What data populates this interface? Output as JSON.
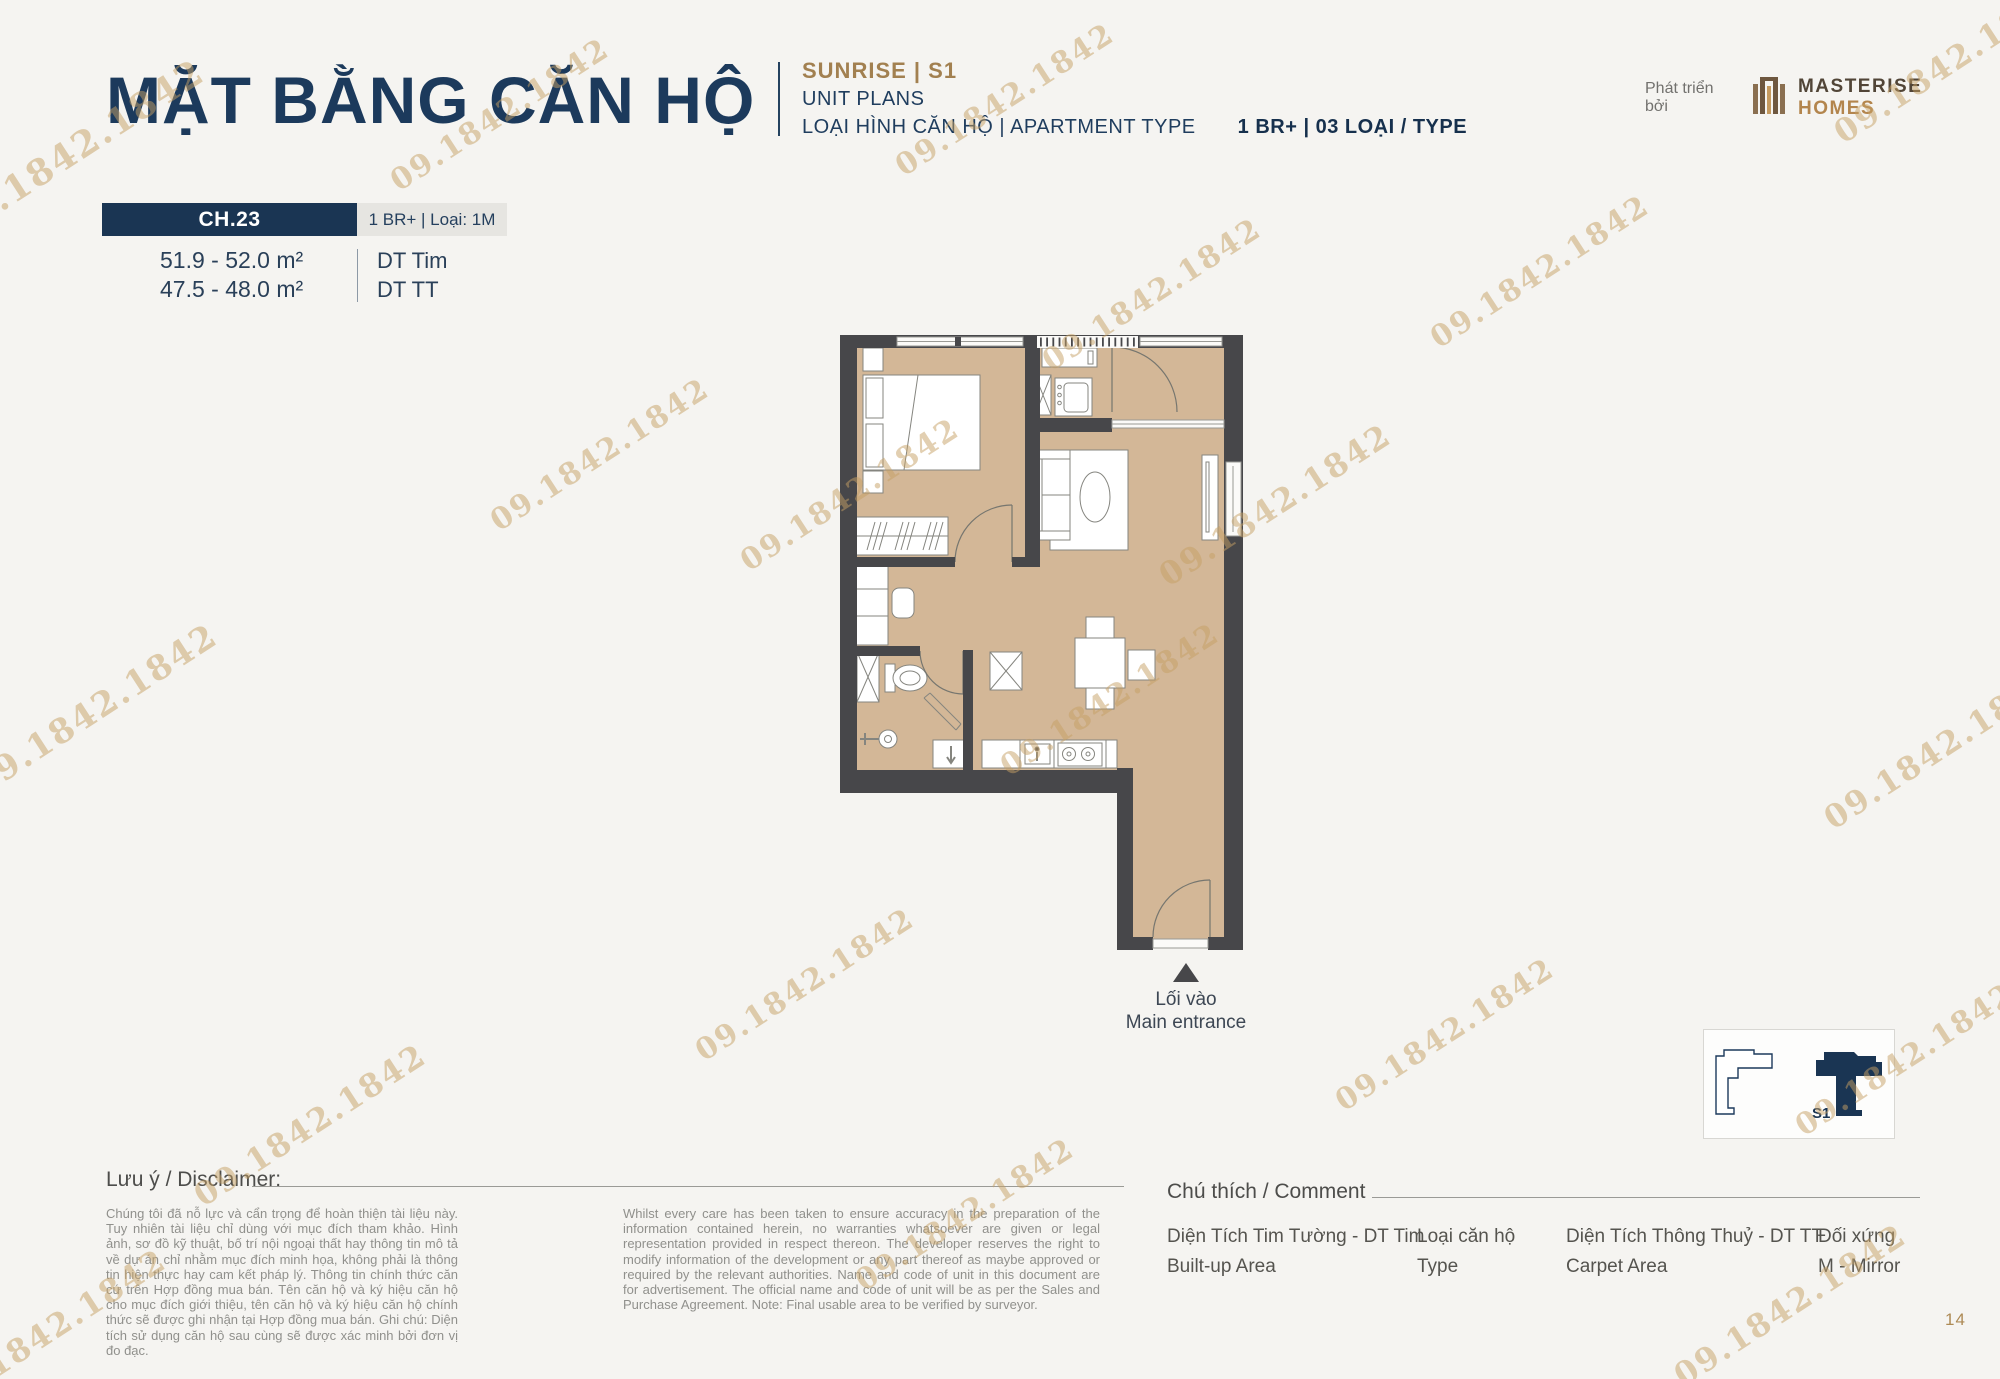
{
  "header": {
    "title": "MẶT BẰNG CĂN HỘ",
    "project_line": "SUNRISE  |  S1",
    "subtitle": "UNIT PLANS",
    "type_line_vi": "LOẠI HÌNH CĂN HỘ  |  APARTMENT TYPE",
    "type_line_bold": "1 BR+  |  03 LOẠI / TYPE",
    "developer_label": "Phát triển bởi",
    "brand_name": "MASTERISE",
    "brand_name2": "HOMES"
  },
  "unit": {
    "code": "CH.23",
    "variant": "1 BR+ | Loại: 1M",
    "area1": "51.9 - 52.0 m²",
    "area1_label": "DT Tim",
    "area2": "47.5 - 48.0 m²",
    "area2_label": "DT TT"
  },
  "plan": {
    "entrance_vi": "Lối vào",
    "entrance_en": "Main entrance",
    "key_plan_label": "S1"
  },
  "watermark": {
    "text": "09.1842.1842",
    "color": "#c6a064"
  },
  "disclaimer": {
    "heading": "Lưu ý / Disclaimer:",
    "text_vi": "Chúng tôi đã nỗ lực và cẩn trọng để hoàn thiện tài liệu này. Tuy nhiên tài liệu chỉ dùng với mục đích tham khảo. Hình ảnh, sơ đồ kỹ thuật, bố trí nội ngoại thất hay thông tin mô tả về dự án chỉ nhằm mục đích minh họa, không phải là thông tin hiện thực hay cam kết pháp lý. Thông tin chính thức căn cứ trên Hợp đồng mua bán. Tên căn hộ và ký hiệu căn hộ cho mục đích giới thiệu, tên căn hộ và ký hiệu căn hộ chính thức sẽ được ghi nhận tại Hợp đồng mua bán. Ghi chú: Diện tích sử dụng căn hộ sau cùng sẽ được xác minh bởi đơn vị đo đạc.",
    "text_en": "Whilst every care has been taken to ensure accuracy in the preparation of the information contained herein, no warranties whatsoever are given or legal representation provided in respect thereon. The developer reserves the right to modify information of the development or any part thereof as maybe approved or required by the relevant authorities. Name and code of unit in this document are for advertisement. The official name and code of unit will be as per the Sales and Purchase Agreement. Note: Final usable area to be verified by surveyor."
  },
  "legend": {
    "heading": "Chú thích / Comment",
    "items": [
      {
        "line1": "Diện Tích Tim Tường - DT Tim",
        "line2": "Built-up Area"
      },
      {
        "line1": "Loại căn hộ",
        "line2": "Type"
      },
      {
        "line1": "Diện Tích Thông Thuỷ - DT TT",
        "line2": "Carpet Area"
      },
      {
        "line1": "Đối xứng",
        "line2": "M - Mirror"
      }
    ]
  },
  "footer": {
    "page_number": "14"
  },
  "colors": {
    "navy": "#1c3a5c",
    "gold": "#b3854d",
    "accent": "#a28050",
    "wall": "#47474a",
    "floor": "#d3b797",
    "page_bg": "#f5f4f1"
  }
}
